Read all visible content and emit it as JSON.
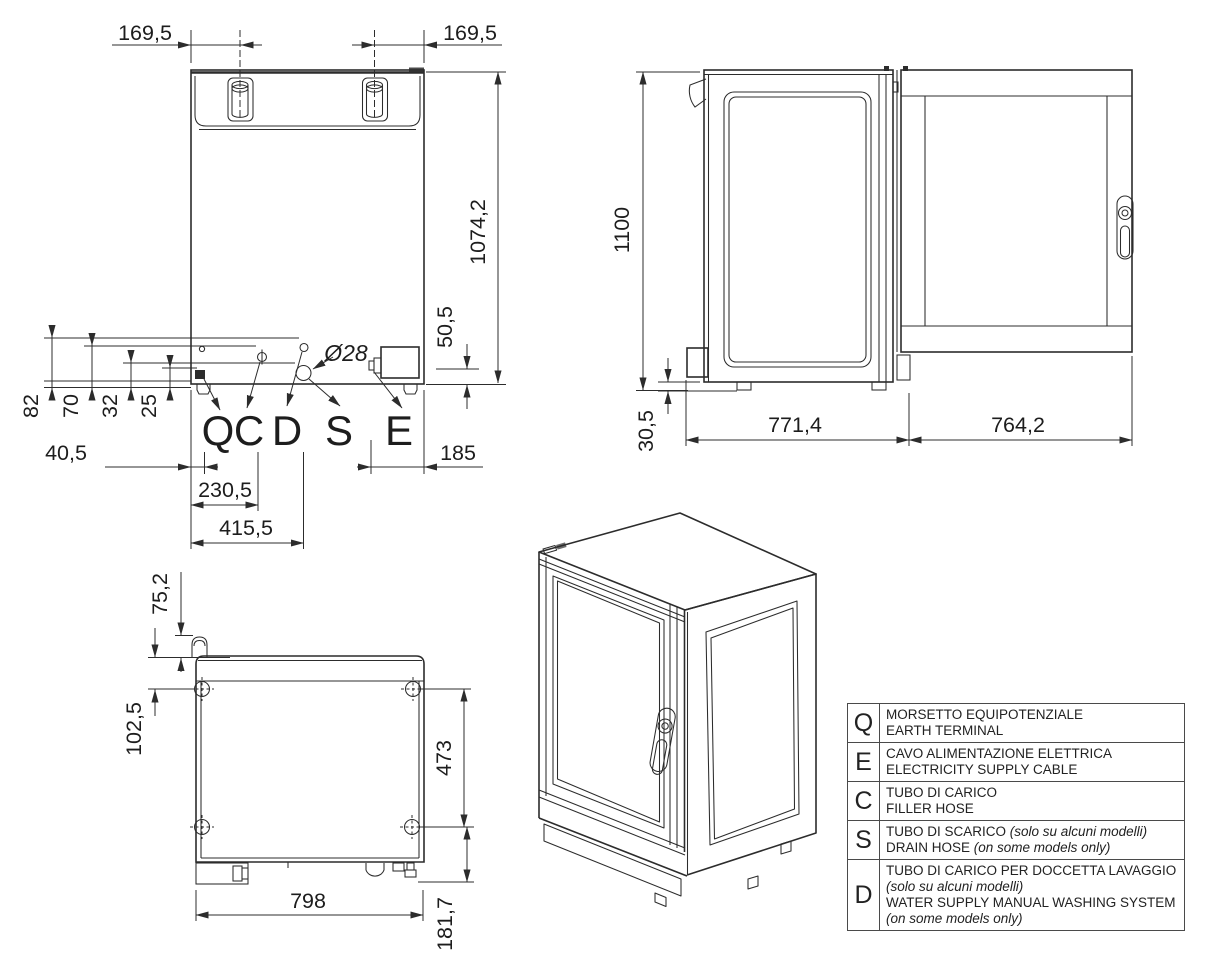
{
  "colors": {
    "line": "#2c2c2c",
    "background": "#ffffff"
  },
  "views": {
    "rear": {
      "dim_169_left": "169,5",
      "dim_169_right": "169,5",
      "dim_height": "1074,2",
      "dim_50_5": "50,5",
      "dim_82": "82",
      "dim_70": "70",
      "dim_32": "32",
      "dim_25": "25",
      "dim_40_5": "40,5",
      "dim_230_5": "230,5",
      "dim_415_5": "415,5",
      "dim_185": "185",
      "dim_diameter": "Ø28",
      "label_q": "Q",
      "label_c": "C",
      "label_d": "D",
      "label_s": "S",
      "label_e": "E"
    },
    "side": {
      "dim_height": "1100",
      "dim_base": "30,5",
      "dim_depth": "771,4",
      "dim_door": "764,2"
    },
    "top": {
      "dim_pipe": "75,2",
      "dim_offset": "102,5",
      "dim_span": "473",
      "dim_width": "798",
      "dim_rear": "181,7"
    }
  },
  "legend": {
    "rows": [
      {
        "key": "Q",
        "it": "MORSETTO EQUIPOTENZIALE",
        "it_note": "",
        "en": "EARTH TERMINAL",
        "en_note": ""
      },
      {
        "key": "E",
        "it": "CAVO ALIMENTAZIONE ELETTRICA",
        "it_note": "",
        "en": "ELECTRICITY SUPPLY CABLE",
        "en_note": ""
      },
      {
        "key": "C",
        "it": "TUBO DI CARICO",
        "it_note": "",
        "en": "FILLER HOSE",
        "en_note": ""
      },
      {
        "key": "S",
        "it": "TUBO DI SCARICO",
        "it_note": "(solo su alcuni modelli)",
        "en": "DRAIN HOSE",
        "en_note": "(on some models only)"
      },
      {
        "key": "D",
        "it": "TUBO DI CARICO PER DOCCETTA LAVAGGIO",
        "it_note": "(solo su alcuni modelli)",
        "en": "WATER SUPPLY MANUAL WASHING SYSTEM",
        "en_note": "(on some models only)"
      }
    ]
  }
}
